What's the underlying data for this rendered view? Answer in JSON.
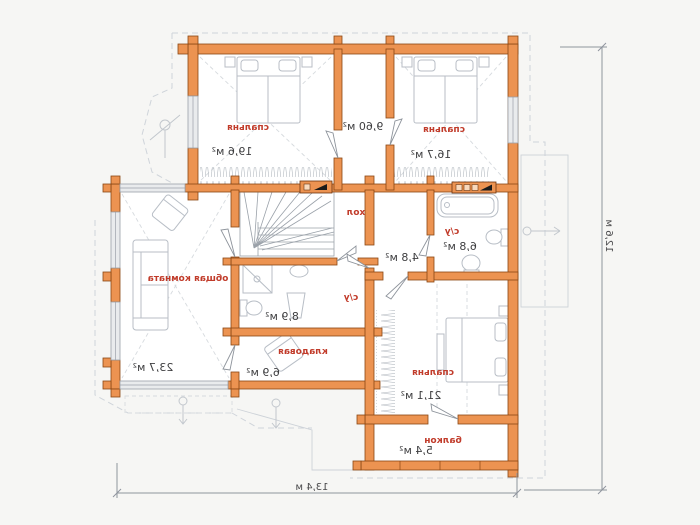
{
  "plan": {
    "type": "second-floor plan, mirrored print",
    "labels": {
      "bedroom1_name": "спальня",
      "bedroom1_area": "19,6 м²",
      "corridor_area": "9,60 м²",
      "bedroom2_name": "спальня",
      "bedroom2_area": "16,7 м²",
      "living_name": "общая комната",
      "living_area": "23,7 м²",
      "hall_name": "хол",
      "bath1_name": "с/у",
      "bath1_area": "6,8 м²",
      "vestibule_area": "4,8 м²",
      "bath2_name": "с/у",
      "bath2_area": "8,9 м²",
      "storage_name": "кладовая",
      "storage_area": "6,9 м²",
      "bedroom3_name": "спальня",
      "bedroom3_area": "21,1 м²",
      "balcony_name": "балкон",
      "balcony_area": "5,4 м²"
    },
    "dimensions": {
      "bottom": "13,4 м",
      "right": "12,6 м"
    },
    "colors": {
      "wall_fill": "#ec9351",
      "wall_stroke": "#8a4613",
      "room_name": "#c13b2a",
      "room_area": "#3e3e40",
      "furniture": "#b8bec6"
    }
  }
}
